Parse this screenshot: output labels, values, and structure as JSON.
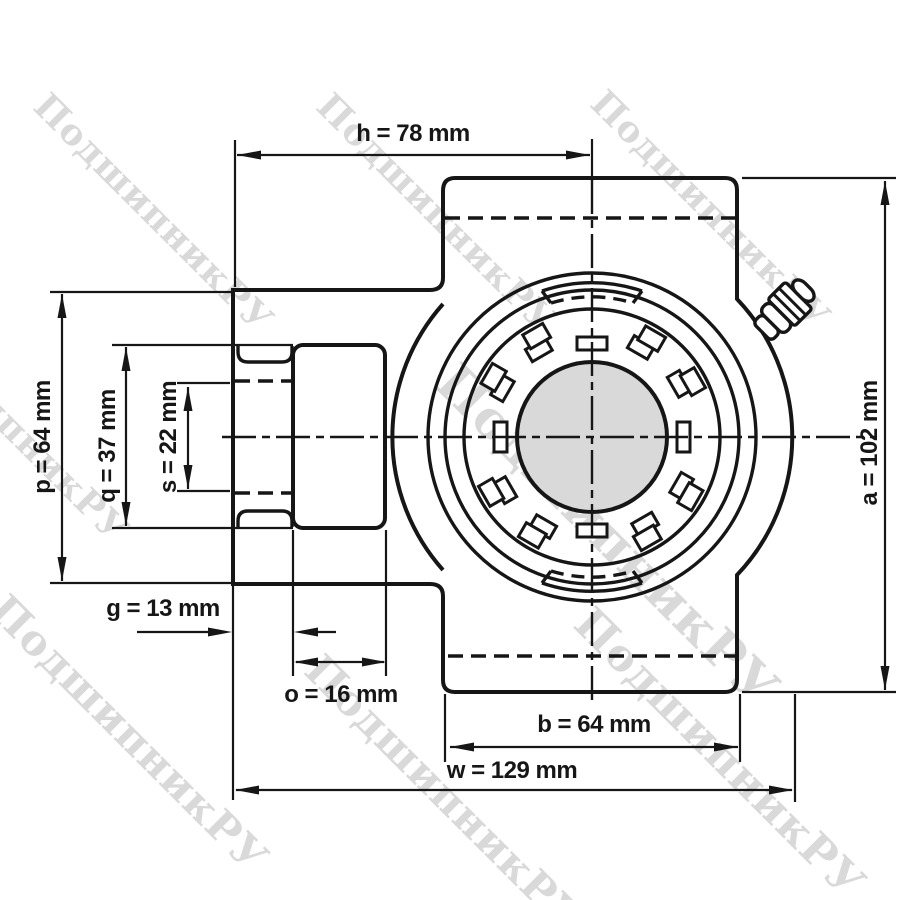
{
  "watermark": {
    "text": "ПодшипникРУ"
  },
  "colors": {
    "line": "#161616",
    "background": "#ffffff",
    "bore_fill": "#d9d9d9"
  },
  "dimensions": {
    "h": {
      "name": "h",
      "value": 78,
      "unit": "mm",
      "label": "h = 78 mm"
    },
    "a": {
      "name": "a",
      "value": 102,
      "unit": "mm",
      "label": "a = 102 mm"
    },
    "p": {
      "name": "p",
      "value": 64,
      "unit": "mm",
      "label": "p = 64 mm"
    },
    "q": {
      "name": "q",
      "value": 37,
      "unit": "mm",
      "label": "q = 37 mm"
    },
    "s": {
      "name": "s",
      "value": 22,
      "unit": "mm",
      "label": "s = 22 mm"
    },
    "g": {
      "name": "g",
      "value": 13,
      "unit": "mm",
      "label": "g = 13 mm"
    },
    "o": {
      "name": "o",
      "value": 16,
      "unit": "mm",
      "label": "o = 16 mm"
    },
    "b": {
      "name": "b",
      "value": 64,
      "unit": "mm",
      "label": "b = 64 mm"
    },
    "w": {
      "name": "w",
      "value": 129,
      "unit": "mm",
      "label": "w = 129 mm"
    }
  }
}
